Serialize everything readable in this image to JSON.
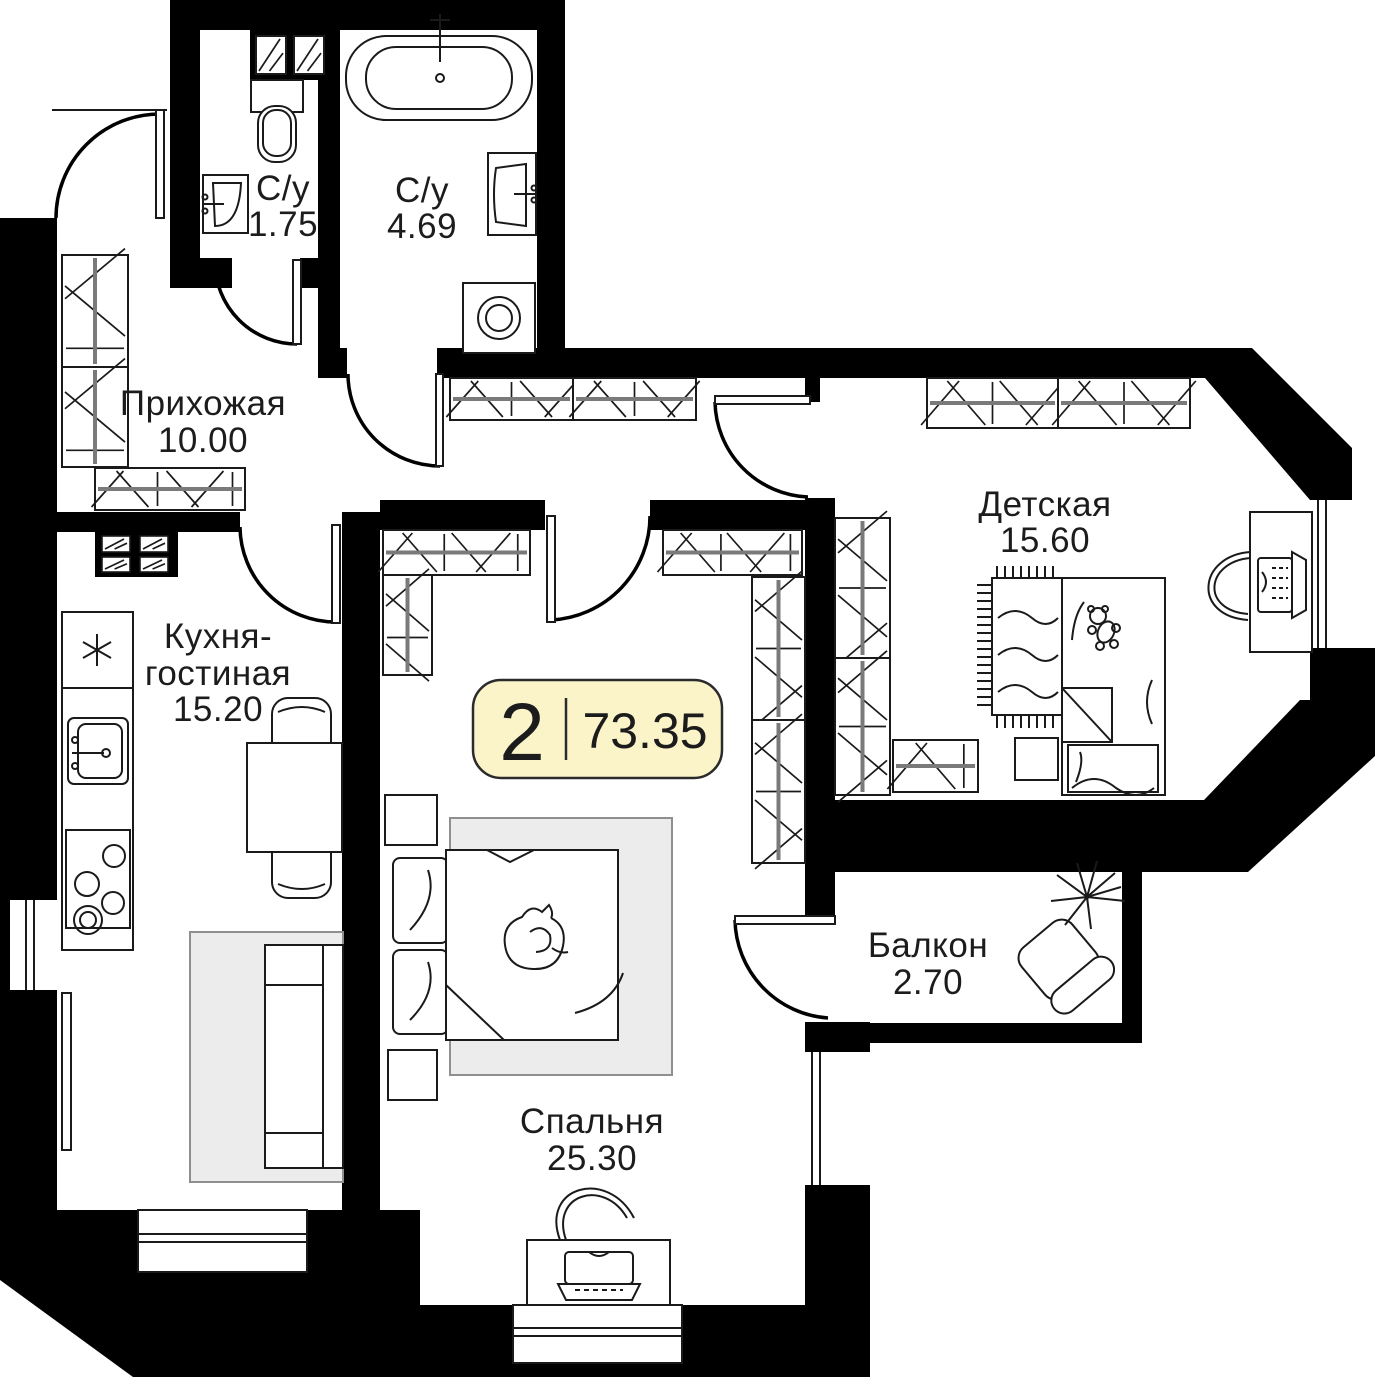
{
  "badge": {
    "room_count": "2",
    "total_area": "73.35"
  },
  "rooms": [
    {
      "key": "bathroom-small",
      "label": "С/у",
      "area": "1.75"
    },
    {
      "key": "bathroom-large",
      "label": "С/у",
      "area": "4.69"
    },
    {
      "key": "hallway",
      "label": "Прихожая",
      "area": "10.00"
    },
    {
      "key": "kitchen-living",
      "label_line1": "Кухня-",
      "label_line2": "гостиная",
      "area": "15.20"
    },
    {
      "key": "children-room",
      "label": "Детская",
      "area": "15.60"
    },
    {
      "key": "bedroom",
      "label": "Спальня",
      "area": "25.30"
    },
    {
      "key": "balcony",
      "label": "Балкон",
      "area": "2.70"
    }
  ],
  "colors": {
    "wall": "#000000",
    "badge_fill": "#FBF4C9",
    "badge_border": "#2b2b2b",
    "furniture_line": "#1a1a1a",
    "soft_gray": "#ececec"
  }
}
